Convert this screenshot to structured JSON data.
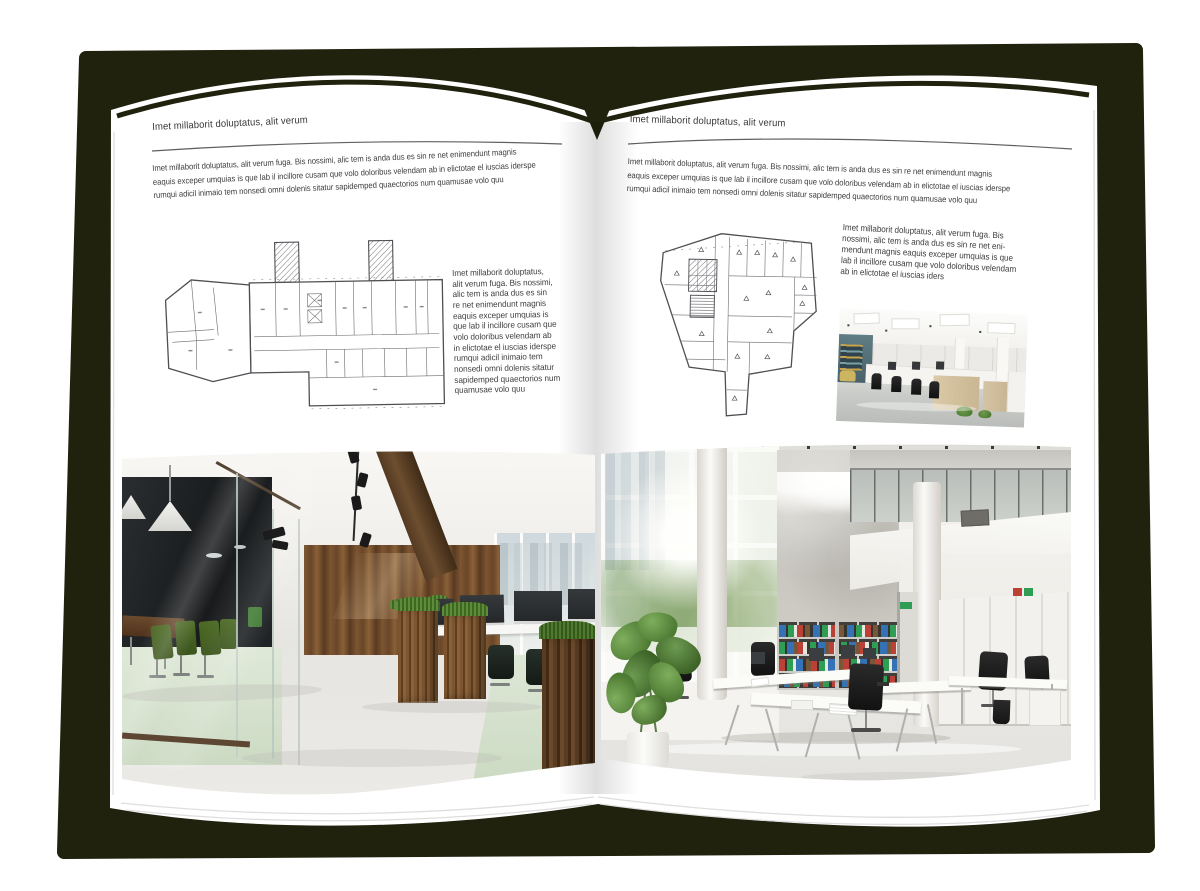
{
  "colors": {
    "backdrop": "#20220e",
    "page": "#ffffff",
    "ink": "#3e3e40",
    "rule": "#606064",
    "plan": "#4e4f53",
    "wood": "#7b5433",
    "wood-dark": "#46311d",
    "beam": "#4a3522",
    "leaf": "#527c36",
    "chair-green": "#43601e",
    "dark-room": "#1f2426",
    "floor-green": "#d7e2d0",
    "concrete": "#ccc9c2",
    "binder-red": "#bb4137",
    "binder-green": "#2f9e54",
    "binder-blue": "#3472b5",
    "floor-light": "#e7e6e2",
    "monitor": "#2b2f31",
    "chair-black": "#1c1d1e"
  },
  "left_page": {
    "header": "Imet millaborit doluptatus, alit verum",
    "intro": "Imet millaborit doluptatus, alit verum fuga. Bis nossimi, alic tem is anda dus es sin re net enimendunt magnis\neaquis exceper umquias is que lab il incillore cusam que volo doloribus velendam ab in elictotae el iuscias iderspe\nrumqui adicil inimaio tem nonsedi omni dolenis sitatur sapidemped quaectorios num quamusae volo quu",
    "caption": "Imet millaborit doluptatus,\nalit verum fuga. Bis nossimi,\nalic tem is anda dus es sin\nre net enimendunt magnis\neaquis exceper umquias is\nque lab il incillore cusam que\nvolo doloribus velendam ab\nin elictotae el iuscias iderspe\nrumqui adicil inimaio tem\nnonsedi omni dolenis sitatur\nsapidemped quaectorios num\nquamusae volo quu"
  },
  "right_page": {
    "header": "Imet millaborit doluptatus, alit verum",
    "intro": "Imet millaborit doluptatus, alit verum fuga. Bis nossimi, alic tem is anda dus es sin re net enimendunt magnis\neaquis exceper umquias is que lab il incillore cusam que volo doloribus velendam ab in elictotae el iuscias iderspe\nrumqui adicil inimaio tem nonsedi omni dolenis sitatur sapidemped quaectorios num quamusae volo quu",
    "caption": "Imet millaborit doluptatus, alit verum fuga. Bis\nnossimi, alic tem is anda dus es sin re net eni-\nmendunt magnis eaquis exceper umquias is que\nlab il incillore cusam que volo doloribus velendam\nab in elictotae el iuscias iders"
  }
}
